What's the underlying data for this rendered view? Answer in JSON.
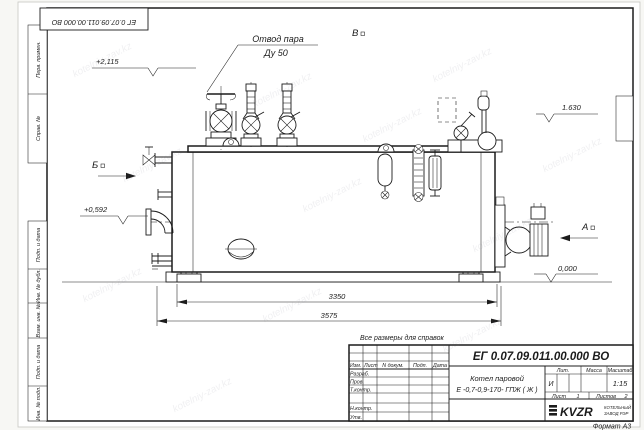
{
  "doc": {
    "number": "ЕГ 0.07.09.011.00.000  ВО",
    "format_label": "Формат А3",
    "note": "Все размеры для справок"
  },
  "labels": {
    "steam_outlet_line1": "Отвод пара",
    "steam_outlet_line2": "Ду 50",
    "view_v": "В",
    "view_b": "Б",
    "view_a": "А"
  },
  "elevations": {
    "e1": "+2,115",
    "e2": "+0,592",
    "e3": "1.630",
    "e4": "0,000"
  },
  "dimensions": {
    "d1": "3350",
    "d2": "3575"
  },
  "margin": {
    "top": [
      "Перв. примен.",
      "Справ. №"
    ],
    "bottom": [
      "Подп. и дата",
      "Инв. № дубл.",
      "Взам. инв. №",
      "Подп. и дата",
      "Инв. № подл."
    ]
  },
  "title_block": {
    "header": {
      "izm": "Изм.",
      "list": "Лист",
      "ndoc": "N докум.",
      "podp": "Подп.",
      "data": "Дата"
    },
    "rows": [
      "Разраб.",
      "Пров.",
      "Т.контр.",
      "Н.контр.",
      "Утв."
    ],
    "name_line1": "Котел паровой",
    "name_line2": "Е -0,7-0,9-170- ГПЖ ( Ж )",
    "lit_label": "Лит.",
    "lit_value": "И",
    "mass_label": "Масса",
    "scale_label": "Масштаб",
    "scale_value": "1:15",
    "sheet_label": "Лист",
    "sheet_value": "1",
    "sheets_label": "Листов",
    "sheets_value": "2",
    "logo_text": "KVZR",
    "logo_sub1": "КОТЕЛЬНЫЙ",
    "logo_sub2": "ЗАВОД РЭР"
  },
  "watermark": {
    "text": "kotelniy-zav.kz"
  },
  "colors": {
    "line": "#1c1c1c",
    "paper": "#ffffff"
  }
}
